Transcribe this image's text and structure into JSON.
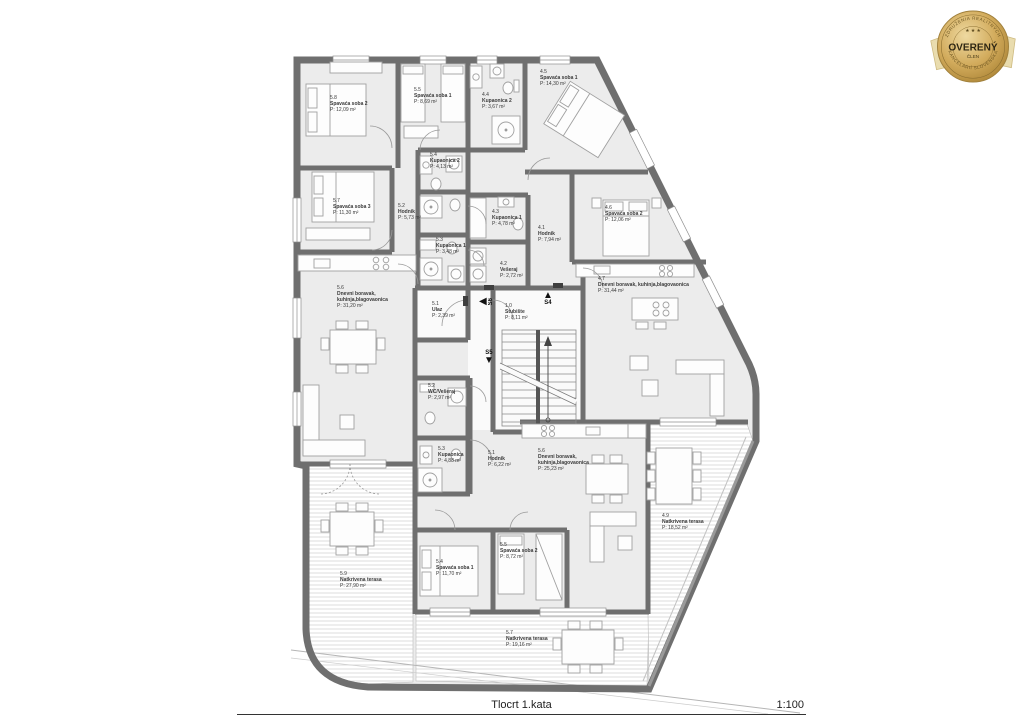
{
  "badge": {
    "arc_top": "ZDRUŽENIA REALITNÝCH",
    "arc_bottom": "KANCELÁRIÍ SLOVENSKA",
    "title": "OVERENÝ",
    "subtitle": "ČLEN",
    "stars": "★ ★ ★",
    "gold": "#caa24d",
    "gold_dark": "#8a6d2f"
  },
  "footer": {
    "title": "Tlocrt 1.kata",
    "scale": "1:100"
  },
  "colors": {
    "wall": "#6f6f6f",
    "room_fill": "#ececec",
    "furniture_line": "#a0a0a0",
    "text": "#3a3a3a"
  },
  "rooms": [
    {
      "id": "5.8",
      "name": "Spavaća soba 2",
      "area": "P: 12,09 m²",
      "x": 330,
      "y": 96
    },
    {
      "id": "5.5",
      "name": "Spavaća soba 1",
      "area": "P: 8,69 m²",
      "x": 414,
      "y": 88
    },
    {
      "id": "4.4",
      "name": "Kupaonica 2",
      "area": "P: 3,67 m²",
      "x": 482,
      "y": 93
    },
    {
      "id": "4.5",
      "name": "Spavaća soba 1",
      "area": "P: 14,30 m²",
      "x": 540,
      "y": 70
    },
    {
      "id": "5.4",
      "name": "Kupaonica 2",
      "area": "P: 4,13 m²",
      "x": 430,
      "y": 153
    },
    {
      "id": "5.7",
      "name": "Spavaća soba 3",
      "area": "P: 11,30 m²",
      "x": 333,
      "y": 199
    },
    {
      "id": "5.2",
      "name": "Hodnik",
      "area": "P: 5,73 m²",
      "x": 398,
      "y": 204
    },
    {
      "id": "4.3",
      "name": "Kupaonica 1",
      "area": "P: 4,78 m²",
      "x": 492,
      "y": 210
    },
    {
      "id": "4.1",
      "name": "Hodnik",
      "area": "P: 7,94 m²",
      "x": 538,
      "y": 226
    },
    {
      "id": "4.6",
      "name": "Spavaća soba 2",
      "area": "P: 12,06 m²",
      "x": 605,
      "y": 206
    },
    {
      "id": "5.3",
      "name": "Kupaonica 1",
      "area": "P: 3,48 m²",
      "x": 436,
      "y": 238
    },
    {
      "id": "4.2",
      "name": "Vešeraj",
      "area": "P: 2,72 m²",
      "x": 500,
      "y": 262
    },
    {
      "id": "4.7",
      "name": "Dnevni boravak, kuhinja,blagovaonica",
      "area": "P: 31,44 m²",
      "x": 598,
      "y": 277
    },
    {
      "id": "5.6",
      "name": "Dnevni boravak,\nkuhinja,blagovaonica",
      "area": "P: 31,20 m²",
      "x": 337,
      "y": 286
    },
    {
      "id": "5.1",
      "name": "Ulaz",
      "area": "P: 2,39 m²",
      "x": 432,
      "y": 302
    },
    {
      "id": "1.0",
      "name": "Stubište",
      "area": "P: 8,11 m²",
      "x": 505,
      "y": 304
    },
    {
      "id": "5.2",
      "name": "WC/Vešeraj",
      "area": "P: 2,97 m²",
      "x": 428,
      "y": 384
    },
    {
      "id": "5.3",
      "name": "Kupaonica",
      "area": "P: 4,88 m²",
      "x": 438,
      "y": 447
    },
    {
      "id": "5.1",
      "name": "Hodnik",
      "area": "P: 6,22 m²",
      "x": 488,
      "y": 451
    },
    {
      "id": "5.6",
      "name": "Dnevni boravak,\nkuhinja,blagovaonica",
      "area": "P: 25,23 m²",
      "x": 538,
      "y": 449
    },
    {
      "id": "5.4",
      "name": "Spavaća soba 1",
      "area": "P: 11,70 m²",
      "x": 436,
      "y": 560
    },
    {
      "id": "5.5",
      "name": "Spavaća soba 2",
      "area": "P: 8,72 m²",
      "x": 500,
      "y": 543
    },
    {
      "id": "5.9",
      "name": "Natkrivena terasa",
      "area": "P: 27,90 m²",
      "x": 340,
      "y": 572
    },
    {
      "id": "4.9",
      "name": "Natkrivena terasa",
      "area": "P: 18,52 m²",
      "x": 662,
      "y": 514
    },
    {
      "id": "5.7",
      "name": "Natkrivena terasa",
      "area": "P: 19,16 m²",
      "x": 506,
      "y": 631
    }
  ],
  "arrows": [
    {
      "label": "S4",
      "dir": "up",
      "x": 543,
      "y": 291
    },
    {
      "label": "S5",
      "dir": "down",
      "x": 484,
      "y": 350
    },
    {
      "label": "S6",
      "dir": "left",
      "x": 479,
      "y": 297
    }
  ]
}
